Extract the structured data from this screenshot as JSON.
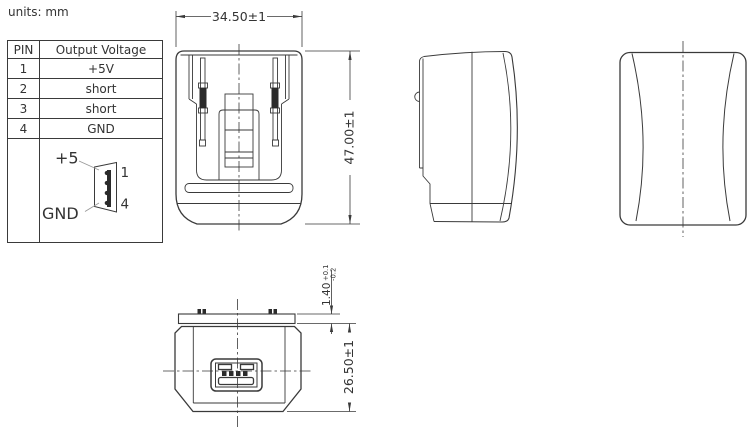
{
  "page": {
    "units_label": "units: mm"
  },
  "colors": {
    "line": "#3a3a3a",
    "text": "#333333",
    "background": "#ffffff"
  },
  "pin_table": {
    "headers": {
      "pin": "PIN",
      "voltage": "Output Voltage"
    },
    "rows": [
      {
        "pin": "1",
        "voltage": "+5V"
      },
      {
        "pin": "2",
        "voltage": "short"
      },
      {
        "pin": "3",
        "voltage": "short"
      },
      {
        "pin": "4",
        "voltage": "GND"
      }
    ]
  },
  "connector_diagram": {
    "plus_label": "+5",
    "gnd_label": "GND",
    "pin1_label": "1",
    "pin4_label": "4"
  },
  "dimensions": {
    "width": "34.50±1",
    "height": "47.00±1",
    "flange_thickness": "1.40",
    "flange_tol_plus": "+0.1",
    "flange_tol_minus": "-0.2",
    "depth": "26.50±1"
  }
}
